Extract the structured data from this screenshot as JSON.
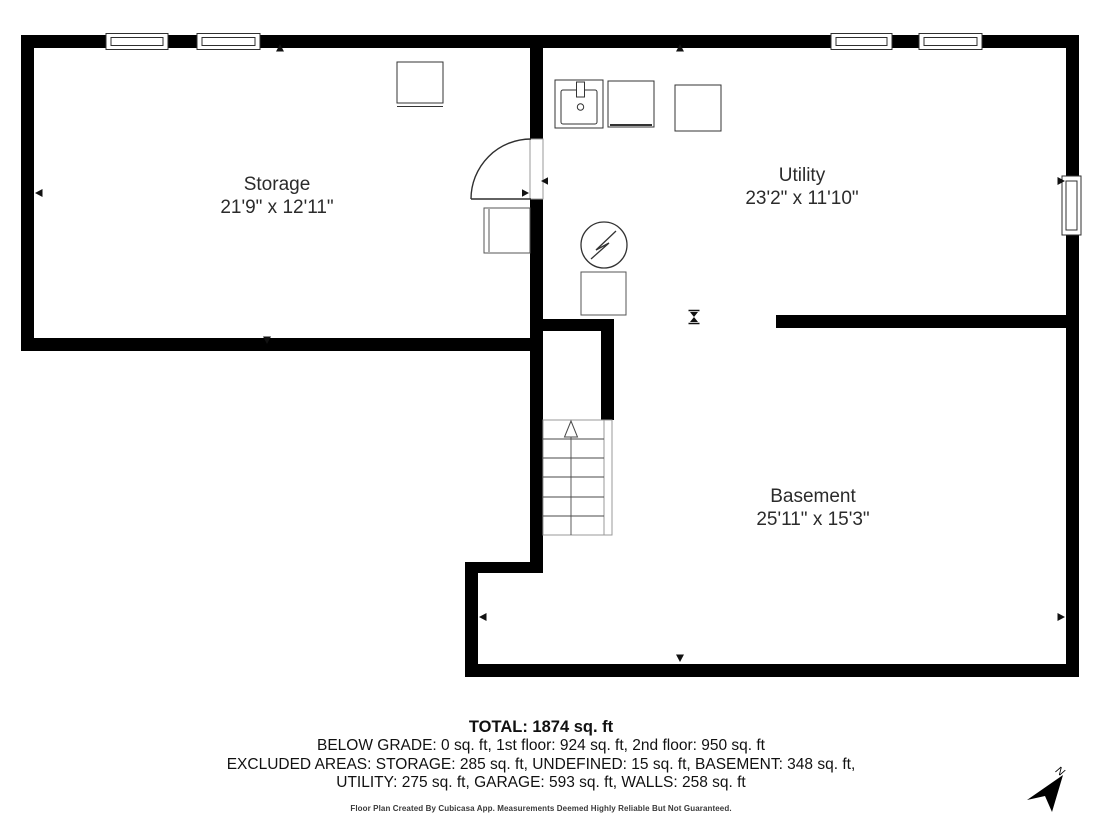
{
  "plan": {
    "rooms": [
      {
        "name": "Storage",
        "dimensions": "21'9\" x 12'11\""
      },
      {
        "name": "Utility",
        "dimensions": "23'2\" x 11'10\""
      },
      {
        "name": "Basement",
        "dimensions": "25'11\" x 15'3\""
      }
    ],
    "compass": {
      "label": "N"
    },
    "stairs_direction": "up"
  },
  "summary": {
    "total": "TOTAL: 1874 sq. ft",
    "grade_line": "BELOW GRADE: 0 sq. ft, 1st floor: 924 sq. ft, 2nd floor: 950 sq. ft",
    "excluded_line_1": "EXCLUDED AREAS: STORAGE: 285 sq. ft, UNDEFINED: 15 sq. ft, BASEMENT: 348 sq. ft,",
    "excluded_line_2": "UTILITY: 275 sq. ft, GARAGE: 593 sq. ft, WALLS: 258 sq. ft"
  },
  "disclaimer": "Floor Plan Created By Cubicasa App. Measurements Deemed Highly Reliable But Not Guaranteed.",
  "icons": {
    "water_heater": "water-heater-circle-bolt-icon",
    "sink": "sink-icon",
    "stairs": "staircase-up-arrow-icon",
    "compass": "north-arrow-icon",
    "door": "door-swing-icon"
  },
  "colors": {
    "wall": "#000000",
    "background": "#ffffff",
    "text": "#2b2b2b",
    "fixture": "#333333",
    "light_gray": "#999999"
  }
}
